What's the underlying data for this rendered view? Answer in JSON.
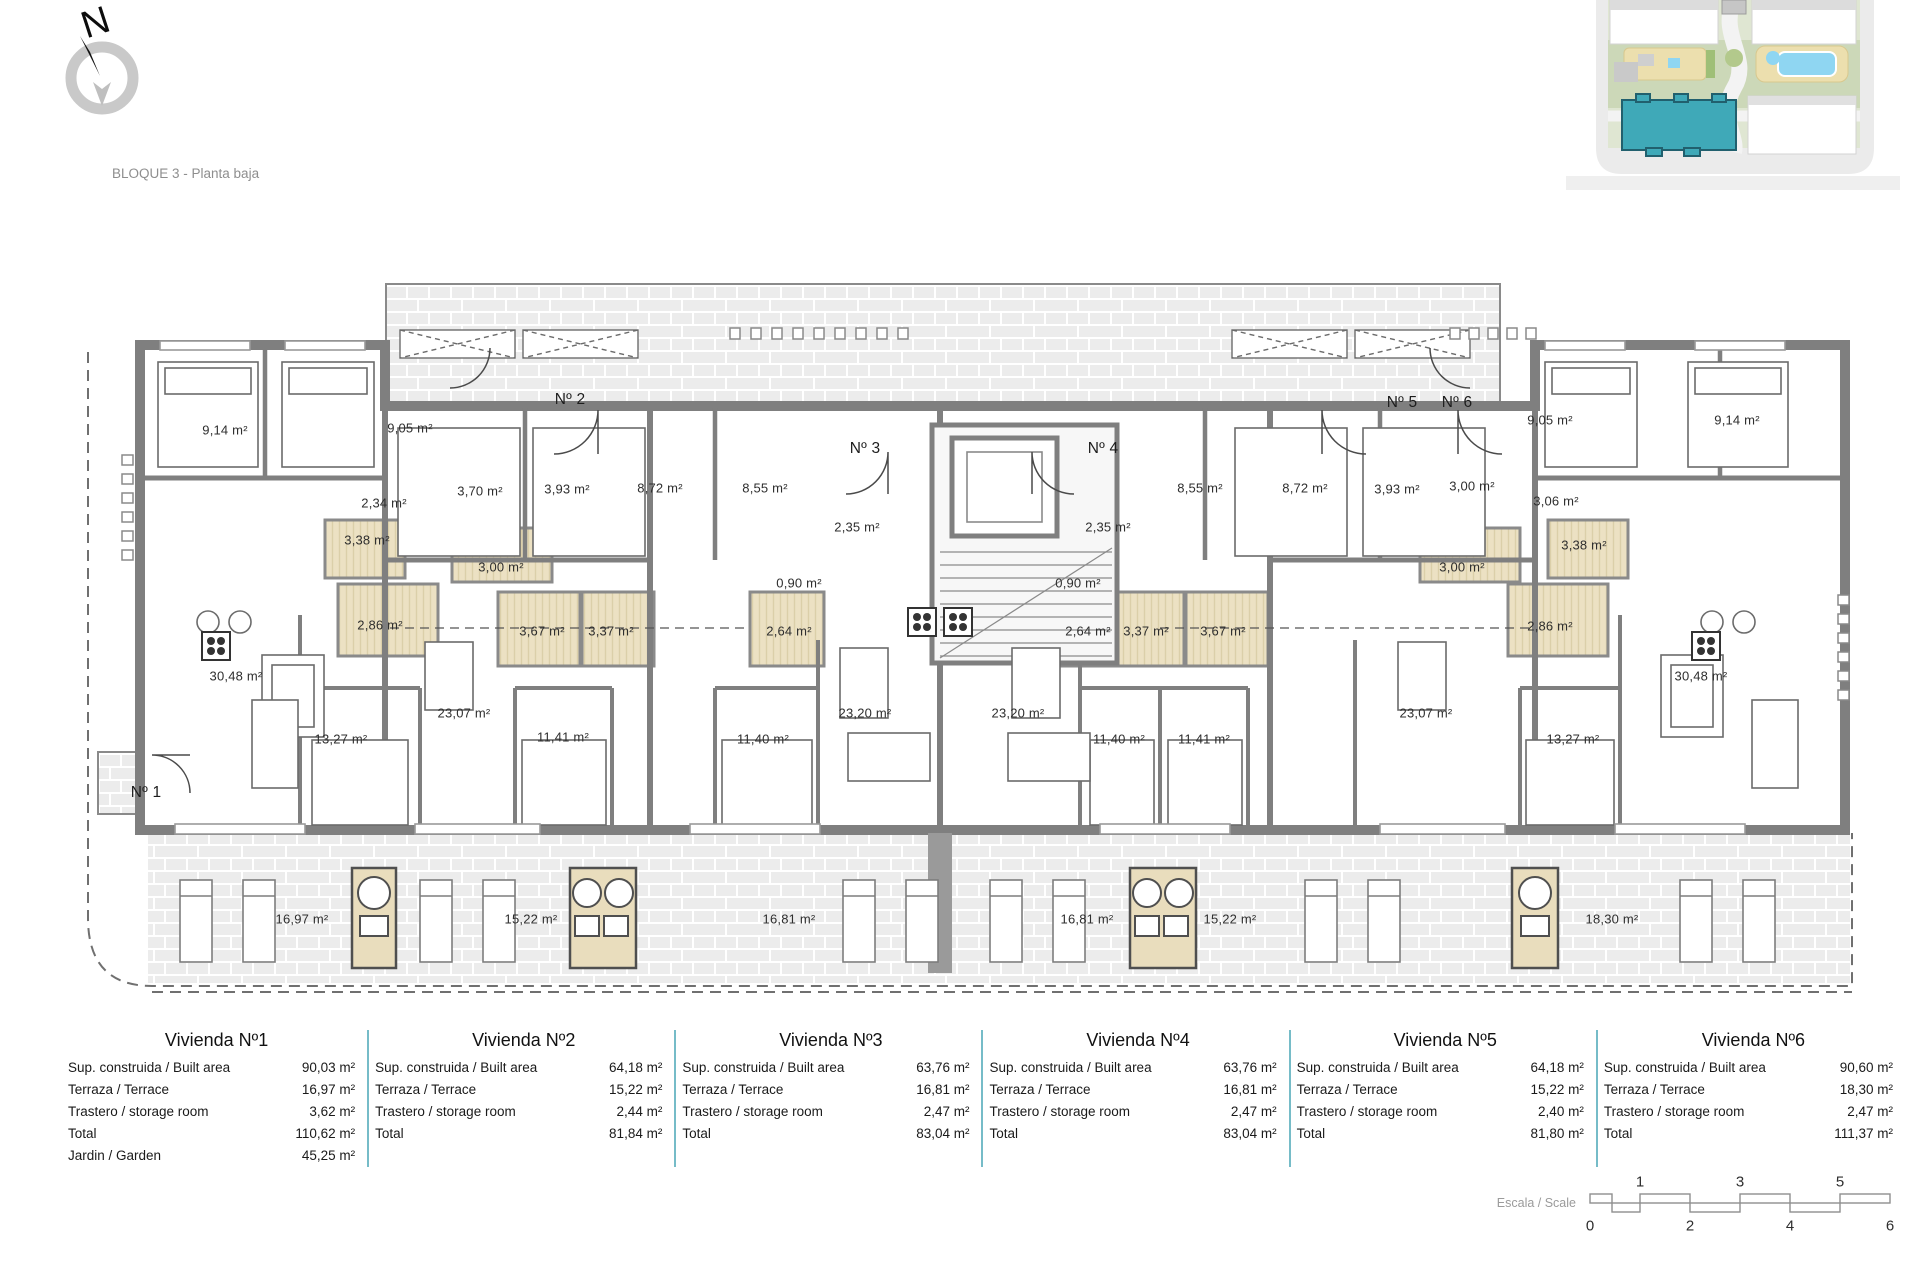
{
  "page": {
    "title": "BLOQUE 3 - Planta baja"
  },
  "compass": {
    "letter": "N"
  },
  "minimap": {
    "name": "site-plan-overview",
    "highlight_color": "#3fa9b8"
  },
  "plan": {
    "unit_labels": [
      {
        "t": "Nº 1",
        "x": 146,
        "y": 793
      },
      {
        "t": "Nº 2",
        "x": 570,
        "y": 400
      },
      {
        "t": "Nº 3",
        "x": 865,
        "y": 449
      },
      {
        "t": "Nº 4",
        "x": 1103,
        "y": 449
      },
      {
        "t": "Nº 5",
        "x": 1402,
        "y": 403
      },
      {
        "t": "Nº 6",
        "x": 1457,
        "y": 403
      }
    ],
    "room_labels": [
      {
        "t": "9,14 m²",
        "x": 225,
        "y": 430
      },
      {
        "t": "9,05 m²",
        "x": 410,
        "y": 428
      },
      {
        "t": "2,34 m²",
        "x": 384,
        "y": 503
      },
      {
        "t": "3,70 m²",
        "x": 480,
        "y": 491,
        "wet": [
          448,
          438,
          64,
          100
        ]
      },
      {
        "t": "3,93 m²",
        "x": 567,
        "y": 489
      },
      {
        "t": "3,38 m²",
        "x": 367,
        "y": 540,
        "wet": [
          325,
          520,
          80,
          58
        ]
      },
      {
        "t": "3,00 m²",
        "x": 501,
        "y": 567,
        "wet": [
          452,
          528,
          100,
          54
        ]
      },
      {
        "t": "2,86 m²",
        "x": 380,
        "y": 625,
        "wet": [
          338,
          584,
          100,
          72
        ]
      },
      {
        "t": "30,48 m²",
        "x": 236,
        "y": 676
      },
      {
        "t": "13,27 m²",
        "x": 341,
        "y": 739
      },
      {
        "t": "8,72 m²",
        "x": 660,
        "y": 488
      },
      {
        "t": "8,55 m²",
        "x": 765,
        "y": 488
      },
      {
        "t": "23,07 m²",
        "x": 464,
        "y": 713
      },
      {
        "t": "3,67 m²",
        "x": 542,
        "y": 631,
        "wet": [
          498,
          592,
          82,
          74
        ]
      },
      {
        "t": "3,37 m²",
        "x": 611,
        "y": 631,
        "wet": [
          582,
          592,
          72,
          74
        ]
      },
      {
        "t": "11,41 m²",
        "x": 563,
        "y": 737
      },
      {
        "t": "11,40 m²",
        "x": 763,
        "y": 739
      },
      {
        "t": "2,35 m²",
        "x": 857,
        "y": 527
      },
      {
        "t": "0,90 m²",
        "x": 799,
        "y": 583
      },
      {
        "t": "2,64 m²",
        "x": 789,
        "y": 631,
        "wet": [
          750,
          592,
          74,
          74
        ]
      },
      {
        "t": "23,20 m²",
        "x": 865,
        "y": 713
      },
      {
        "t": "23,20 m²",
        "x": 1018,
        "y": 713
      },
      {
        "t": "2,35 m²",
        "x": 1108,
        "y": 527
      },
      {
        "t": "0,90 m²",
        "x": 1078,
        "y": 583
      },
      {
        "t": "2,64 m²",
        "x": 1088,
        "y": 631,
        "wet": [
          1050,
          592,
          74,
          74
        ]
      },
      {
        "t": "3,37 m²",
        "x": 1146,
        "y": 631,
        "wet": [
          1112,
          592,
          72,
          74
        ]
      },
      {
        "t": "3,67 m²",
        "x": 1223,
        "y": 631,
        "wet": [
          1186,
          592,
          82,
          74
        ]
      },
      {
        "t": "11,40 m²",
        "x": 1119,
        "y": 739
      },
      {
        "t": "11,41 m²",
        "x": 1204,
        "y": 739
      },
      {
        "t": "8,55 m²",
        "x": 1200,
        "y": 488
      },
      {
        "t": "8,72 m²",
        "x": 1305,
        "y": 488
      },
      {
        "t": "3,93 m²",
        "x": 1397,
        "y": 489
      },
      {
        "t": "3,00 m²",
        "x": 1472,
        "y": 486
      },
      {
        "t": "3,00 m²",
        "x": 1462,
        "y": 567,
        "wet": [
          1420,
          528,
          100,
          54
        ]
      },
      {
        "t": "23,07 m²",
        "x": 1426,
        "y": 713
      },
      {
        "t": "2,86 m²",
        "x": 1550,
        "y": 626,
        "wet": [
          1508,
          584,
          100,
          72
        ]
      },
      {
        "t": "13,27 m²",
        "x": 1573,
        "y": 739
      },
      {
        "t": "30,48 m²",
        "x": 1701,
        "y": 676
      },
      {
        "t": "3,06 m²",
        "x": 1556,
        "y": 501
      },
      {
        "t": "3,38 m²",
        "x": 1584,
        "y": 545,
        "wet": [
          1548,
          520,
          80,
          58
        ]
      },
      {
        "t": "9,05 m²",
        "x": 1550,
        "y": 420
      },
      {
        "t": "9,14 m²",
        "x": 1737,
        "y": 420
      },
      {
        "t": "16,97 m²",
        "x": 302,
        "y": 919
      },
      {
        "t": "15,22 m²",
        "x": 531,
        "y": 919
      },
      {
        "t": "16,81 m²",
        "x": 789,
        "y": 919
      },
      {
        "t": "16,81 m²",
        "x": 1087,
        "y": 919
      },
      {
        "t": "15,22 m²",
        "x": 1230,
        "y": 919
      },
      {
        "t": "18,30 m²",
        "x": 1612,
        "y": 919
      }
    ]
  },
  "apartments": [
    {
      "title": "Vivienda Nº1",
      "rows": [
        {
          "label": "Sup. construida / Built area",
          "value": "90,03 m²"
        },
        {
          "label": "Terraza / Terrace",
          "value": "16,97 m²"
        },
        {
          "label": "Trastero / storage room",
          "value": "3,62 m²"
        },
        {
          "label": "Total",
          "value": "110,62 m²"
        },
        {
          "label": "Jardin / Garden",
          "value": "45,25 m²"
        }
      ]
    },
    {
      "title": "Vivienda Nº2",
      "rows": [
        {
          "label": "Sup. construida / Built area",
          "value": "64,18 m²"
        },
        {
          "label": "Terraza / Terrace",
          "value": "15,22 m²"
        },
        {
          "label": "Trastero / storage room",
          "value": "2,44 m²"
        },
        {
          "label": "Total",
          "value": "81,84 m²"
        }
      ]
    },
    {
      "title": "Vivienda Nº3",
      "rows": [
        {
          "label": "Sup. construida / Built area",
          "value": "63,76 m²"
        },
        {
          "label": "Terraza / Terrace",
          "value": "16,81 m²"
        },
        {
          "label": "Trastero / storage room",
          "value": "2,47 m²"
        },
        {
          "label": "Total",
          "value": "83,04 m²"
        }
      ]
    },
    {
      "title": "Vivienda Nº4",
      "rows": [
        {
          "label": "Sup. construida / Built area",
          "value": "63,76 m²"
        },
        {
          "label": "Terraza / Terrace",
          "value": "16,81 m²"
        },
        {
          "label": "Trastero / storage room",
          "value": "2,47 m²"
        },
        {
          "label": "Total",
          "value": "83,04 m²"
        }
      ]
    },
    {
      "title": "Vivienda Nº5",
      "rows": [
        {
          "label": "Sup. construida / Built area",
          "value": "64,18 m²"
        },
        {
          "label": "Terraza / Terrace",
          "value": "15,22 m²"
        },
        {
          "label": "Trastero / storage room",
          "value": "2,40 m²"
        },
        {
          "label": "Total",
          "value": "81,80 m²"
        }
      ]
    },
    {
      "title": "Vivienda Nº6",
      "rows": [
        {
          "label": "Sup. construida / Built area",
          "value": "90,60 m²"
        },
        {
          "label": "Terraza / Terrace",
          "value": "18,30 m²"
        },
        {
          "label": "Trastero / storage room",
          "value": "2,47 m²"
        },
        {
          "label": "Total",
          "value": "111,37 m²"
        }
      ]
    }
  ],
  "scale_bar": {
    "label": "Escala / Scale",
    "above": [
      {
        "t": "1",
        "x": 1640
      },
      {
        "t": "3",
        "x": 1740
      },
      {
        "t": "5",
        "x": 1840
      }
    ],
    "below": [
      {
        "t": "0",
        "x": 1590
      },
      {
        "t": "2",
        "x": 1690
      },
      {
        "t": "4",
        "x": 1790
      },
      {
        "t": "6",
        "x": 1890
      }
    ]
  }
}
